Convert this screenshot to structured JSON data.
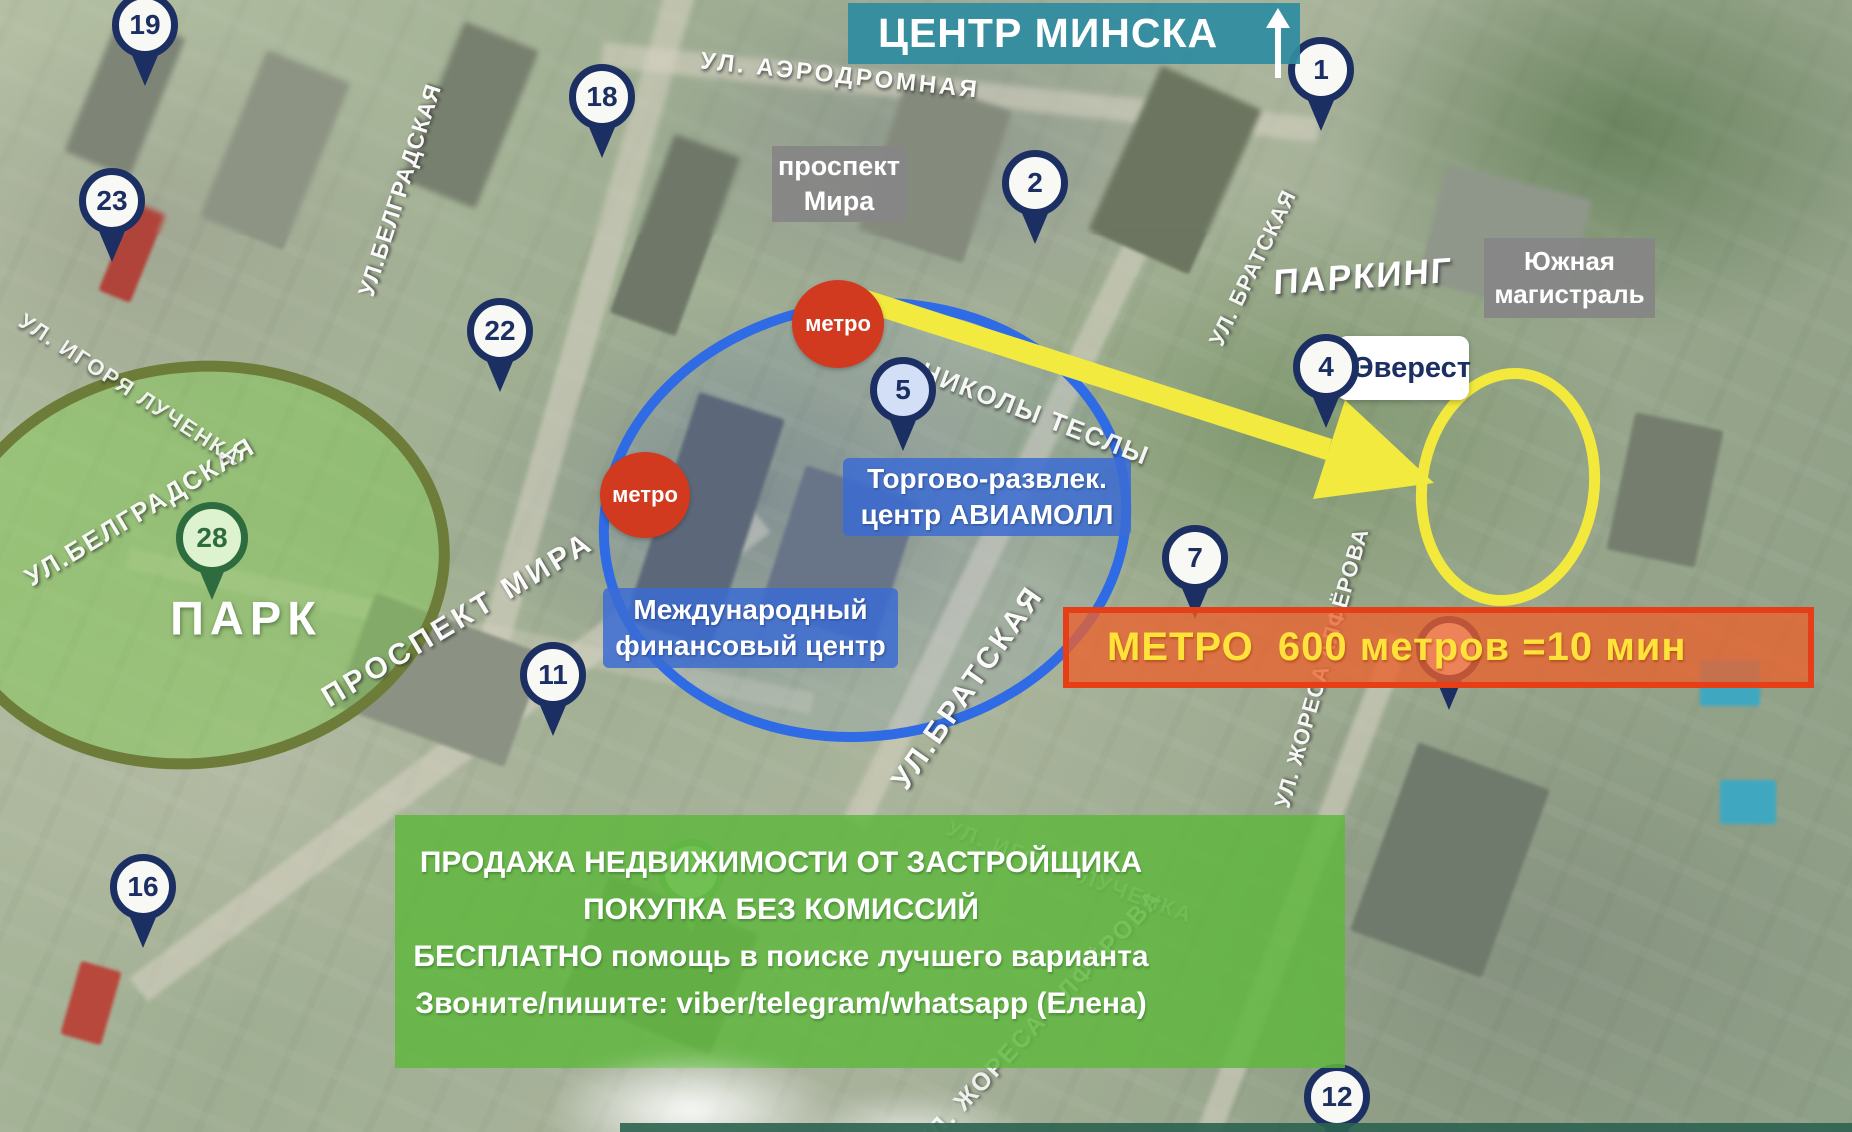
{
  "banners": {
    "title": {
      "text": "ЦЕНТР МИНСКА"
    },
    "metro": {
      "text": "МЕТРО  600 метров =10 мин"
    },
    "ad": {
      "lines": [
        "ПРОДАЖА НЕДВИЖИМОСТИ ОТ ЗАСТРОЙЩИКА",
        "ПОКУПКА БЕЗ КОМИССИЙ",
        "БЕСПЛАТНО помощь в поиске лучшего варианта",
        "Звоните/пишите: viber/telegram/whatsapp (Елена)"
      ]
    }
  },
  "labels": {
    "prospekt_mira": {
      "lines": [
        "проспект",
        "Мира"
      ]
    },
    "yuzhnaya": {
      "lines": [
        "Южная",
        "магистраль"
      ]
    },
    "everest": {
      "text": "Эверест"
    },
    "aviamall": {
      "lines": [
        "Торгово-развлек.",
        "центр АВИАМОЛЛ"
      ]
    },
    "mfc": {
      "lines": [
        "Международный",
        "финансовый центр"
      ]
    },
    "parking": {
      "text": "ПАРКИНГ"
    },
    "park": {
      "text": "ПАРК"
    },
    "metro_badge": {
      "text": "метро"
    }
  },
  "pins": [
    {
      "number": "19",
      "x": 145,
      "y": 25,
      "variant": "navy"
    },
    {
      "number": "23",
      "x": 112,
      "y": 201,
      "variant": "navy"
    },
    {
      "number": "18",
      "x": 602,
      "y": 97,
      "variant": "navy"
    },
    {
      "number": "22",
      "x": 500,
      "y": 331,
      "variant": "navy"
    },
    {
      "number": "2",
      "x": 1035,
      "y": 183,
      "variant": "navy"
    },
    {
      "number": "1",
      "x": 1321,
      "y": 70,
      "variant": "navy"
    },
    {
      "number": "4",
      "x": 1326,
      "y": 367,
      "variant": "navy"
    },
    {
      "number": "5",
      "x": 903,
      "y": 390,
      "variant": "blue"
    },
    {
      "number": "7",
      "x": 1195,
      "y": 558,
      "variant": "navy"
    },
    {
      "number": "11",
      "x": 553,
      "y": 675,
      "variant": "navy"
    },
    {
      "number": "16",
      "x": 143,
      "y": 887,
      "variant": "navy"
    },
    {
      "number": "12",
      "x": 1337,
      "y": 1097,
      "variant": "navy"
    },
    {
      "number": "28",
      "x": 212,
      "y": 538,
      "variant": "green"
    },
    {
      "number": "",
      "x": 1449,
      "y": 649,
      "variant": "navy",
      "layer": "under"
    },
    {
      "number": "",
      "x": 691,
      "y": 872,
      "variant": "green-soft",
      "layer": "under"
    }
  ],
  "street_labels": [
    {
      "text": "УЛ. АЭРОДРОМНАЯ",
      "x": 840,
      "y": 76,
      "rot": 6,
      "size": 24,
      "spacing": 3,
      "opacity": 0.95
    },
    {
      "text": "УЛ.БЕЛГРАДСКАЯ",
      "x": 400,
      "y": 190,
      "rot": -72,
      "size": 23,
      "spacing": 1,
      "opacity": 0.95
    },
    {
      "text": "УЛ.БЕЛГРАДСКАЯ",
      "x": 140,
      "y": 512,
      "rot": -31,
      "size": 26,
      "spacing": 2,
      "opacity": 0.9
    },
    {
      "text": "УЛ. ИГОРЯ ЛУЧЕНКА",
      "x": 130,
      "y": 390,
      "rot": 33,
      "size": 22,
      "spacing": 2,
      "opacity": 0.85
    },
    {
      "text": "ПРОСПЕКТ МИРА",
      "x": 458,
      "y": 620,
      "rot": -31,
      "size": 30,
      "spacing": 4,
      "opacity": 0.95
    },
    {
      "text": "УЛ.БРАТСКАЯ",
      "x": 968,
      "y": 688,
      "rot": -55,
      "size": 30,
      "spacing": 3,
      "opacity": 0.95
    },
    {
      "text": "УЛ. БРАТСКАЯ",
      "x": 1253,
      "y": 268,
      "rot": -64,
      "size": 22,
      "spacing": 1,
      "opacity": 0.9
    },
    {
      "text": "НИКОЛЫ ТЕСЛЫ",
      "x": 1035,
      "y": 414,
      "rot": 21,
      "size": 26,
      "spacing": 2,
      "opacity": 0.9
    },
    {
      "text": "УЛ. ЖОРЕСА АЛФЁРОВА",
      "x": 1322,
      "y": 668,
      "rot": -74,
      "size": 22,
      "spacing": 1,
      "opacity": 0.9
    },
    {
      "text": "УЛ. ЖОРЕСА АЛФЁРОВА",
      "x": 1040,
      "y": 1020,
      "rot": -47,
      "size": 25,
      "spacing": 2,
      "opacity": 0.8
    },
    {
      "text": "УЛ. ИГОРЯ ЛУЧЕНКА",
      "x": 1070,
      "y": 872,
      "rot": 20,
      "size": 22,
      "spacing": 2,
      "opacity": 0.5
    }
  ],
  "colors": {
    "accent_teal": "#2f8ca0",
    "banner_orange_border": "#e63e17",
    "banner_green": "#5fb83e",
    "pin_navy": "#1c2f63",
    "metro_red": "#d23a20",
    "highlight_yellow": "#f2e93c",
    "circle_blue": "#2f6be4",
    "park_olive": "#6d7c39"
  }
}
